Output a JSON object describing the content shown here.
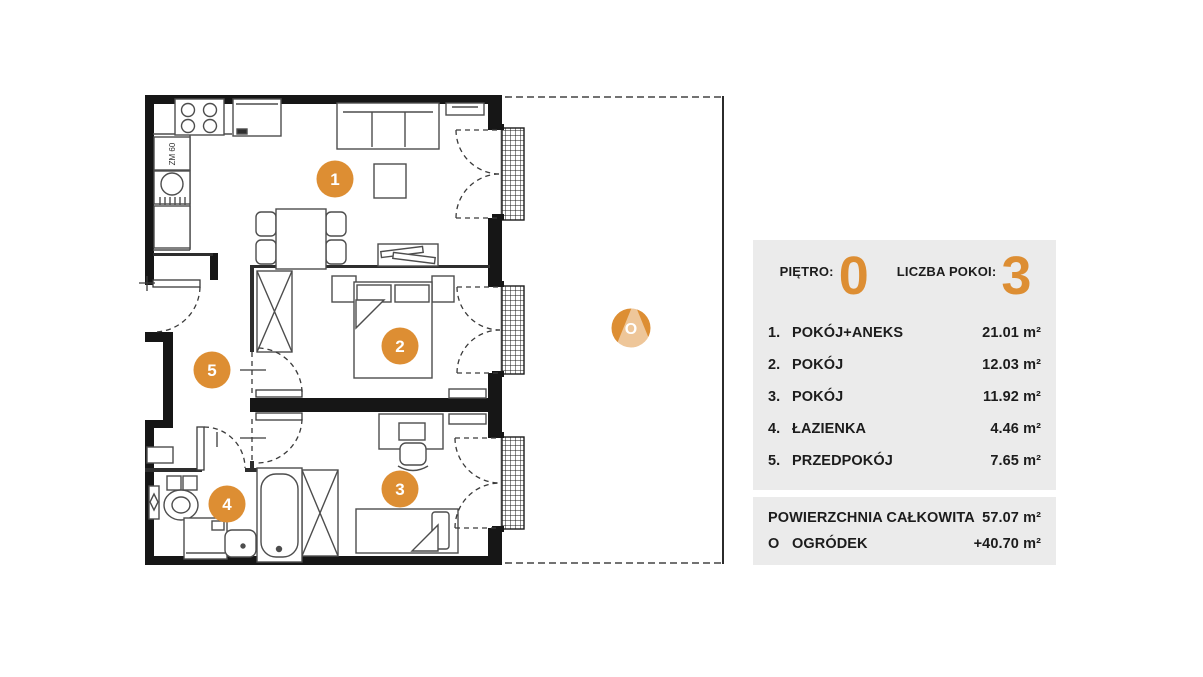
{
  "panel": {
    "floor_label": "PIĘTRO:",
    "floor_value": "0",
    "rooms_label": "LICZBA POKOI:",
    "rooms_value": "3",
    "rooms": [
      {
        "num": "1.",
        "name": "POKÓJ+ANEKS",
        "area": "21.01 m²"
      },
      {
        "num": "2.",
        "name": "POKÓJ",
        "area": "12.03 m²"
      },
      {
        "num": "3.",
        "name": "POKÓJ",
        "area": "11.92 m²"
      },
      {
        "num": "4.",
        "name": "ŁAZIENKA",
        "area": "4.46 m²"
      },
      {
        "num": "5.",
        "name": "PRZEDPOKÓJ",
        "area": "7.65 m²"
      }
    ],
    "totals": [
      {
        "num": "",
        "name": "POWIERZCHNIA CAŁKOWITA",
        "area": "57.07 m²"
      },
      {
        "num": "O",
        "name": "OGRÓDEK",
        "area": "+40.70 m²"
      }
    ]
  },
  "plan": {
    "markers": {
      "room1": "1",
      "room2": "2",
      "room3": "3",
      "room4": "4",
      "room5": "5",
      "garden": "O"
    },
    "labels": {
      "dishwasher": "ZM 60"
    }
  },
  "colors": {
    "accent": "#DD8E33",
    "panel_bg": "#EBEBEB",
    "wall": "#161616",
    "line": "#4d4d4d"
  }
}
